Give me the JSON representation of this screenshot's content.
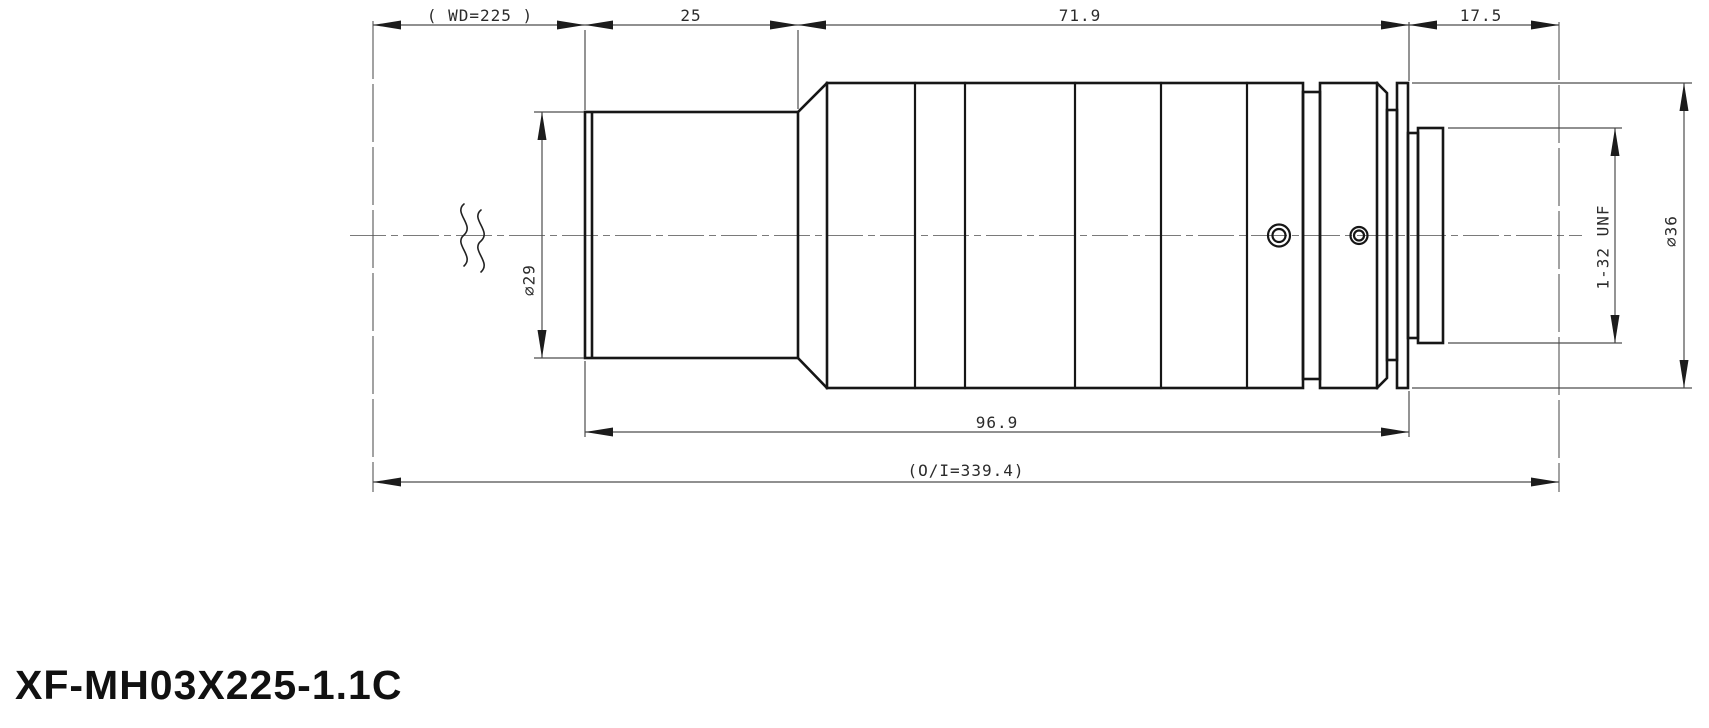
{
  "title": "XF-MH03X225-1.1C",
  "dimensions": {
    "working_distance": "( WD=225 )",
    "front_length": "25",
    "mid_length": "71.9",
    "flange_distance": "17.5",
    "body_length": "96.9",
    "overall_length": "(O/I=339.4)",
    "front_diameter": "⌀29",
    "rear_diameter": "⌀36",
    "mount_thread": "1-32 UNF"
  }
}
